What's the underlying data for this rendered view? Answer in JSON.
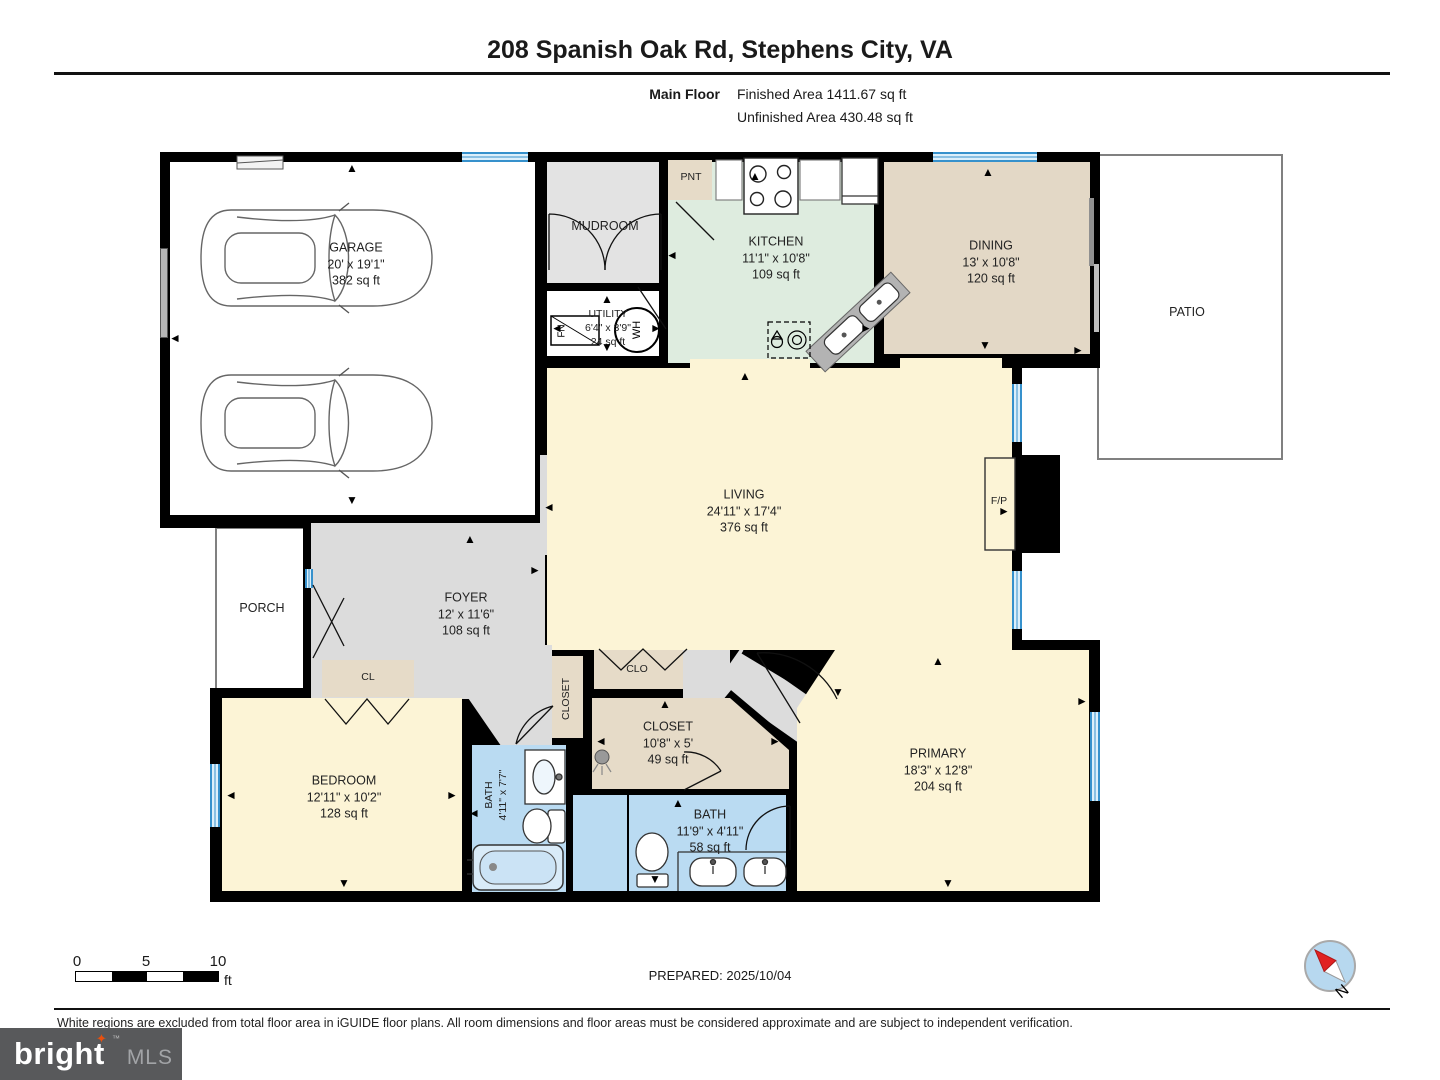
{
  "header": {
    "title": "208 Spanish Oak Rd, Stephens City, VA",
    "floor_label": "Main Floor",
    "finished_area": "Finished Area 1411.67 sq ft",
    "unfinished_area": "Unfinished Area 430.48 sq ft"
  },
  "rooms": {
    "garage": {
      "name": "GARAGE",
      "dims": "20' x 19'1\"",
      "area": "382 sq ft"
    },
    "mudroom": {
      "name": "MUDROOM"
    },
    "pantry": {
      "name": "PNT"
    },
    "kitchen": {
      "name": "KITCHEN",
      "dims": "11'1\" x 10'8\"",
      "area": "109 sq ft"
    },
    "dining": {
      "name": "DINING",
      "dims": "13' x 10'8\"",
      "area": "120 sq ft"
    },
    "patio": {
      "name": "PATIO"
    },
    "utility": {
      "name": "UTILITY",
      "dims": "6'4\" x 3'9\"",
      "area": "24 sq ft"
    },
    "living": {
      "name": "LIVING",
      "dims": "24'11\" x 17'4\"",
      "area": "376 sq ft"
    },
    "fireplace": {
      "name": "F/P"
    },
    "foyer": {
      "name": "FOYER",
      "dims": "12' x 11'6\"",
      "area": "108 sq ft"
    },
    "porch": {
      "name": "PORCH"
    },
    "closet_cl": {
      "name": "CL"
    },
    "closet_hall": {
      "name": "CLOSET"
    },
    "closet_clo": {
      "name": "CLO"
    },
    "closet_primary": {
      "name": "CLOSET",
      "dims": "10'8\" x 5'",
      "area": "49 sq ft"
    },
    "bedroom": {
      "name": "BEDROOM",
      "dims": "12'11\" x 10'2\"",
      "area": "128 sq ft"
    },
    "bath_hall": {
      "name": "BATH",
      "dims": "4'11\" x 7'7\""
    },
    "bath_primary": {
      "name": "BATH",
      "dims": "11'9\" x 4'11\"",
      "area": "58 sq ft"
    },
    "primary": {
      "name": "PRIMARY",
      "dims": "18'3\" x 12'8\"",
      "area": "204 sq ft"
    }
  },
  "fixtures": {
    "water_heater": "WH",
    "furnace": "FN"
  },
  "icons": {
    "arrow_up": "▲",
    "arrow_down": "▼",
    "arrow_left": "◄",
    "arrow_right": "►",
    "logo_star": "✦"
  },
  "scale_bar": {
    "tick_0": "0",
    "tick_5": "5",
    "tick_10": "10",
    "unit": "ft"
  },
  "footer": {
    "prepared": "PREPARED: 2025/10/04",
    "compass_label": "N",
    "disclaimer": "White regions are excluded from total floor area in iGUIDE floor plans. All room dimensions and floor areas must be considered approximate and are subject to independent verification.",
    "logo_brand": "bright",
    "logo_suffix": "MLS",
    "logo_tm": "™"
  },
  "colors": {
    "wall": "#000000",
    "window": "#3691cc",
    "floor_cream": "#fcf4d6",
    "floor_tan": "#e6dbc8",
    "floor_mint": "#deecdf",
    "floor_gray": "#dcdcdc",
    "floor_blue": "#badbf2",
    "logo_bg": "#58595b",
    "logo_accent": "#e8500e"
  }
}
